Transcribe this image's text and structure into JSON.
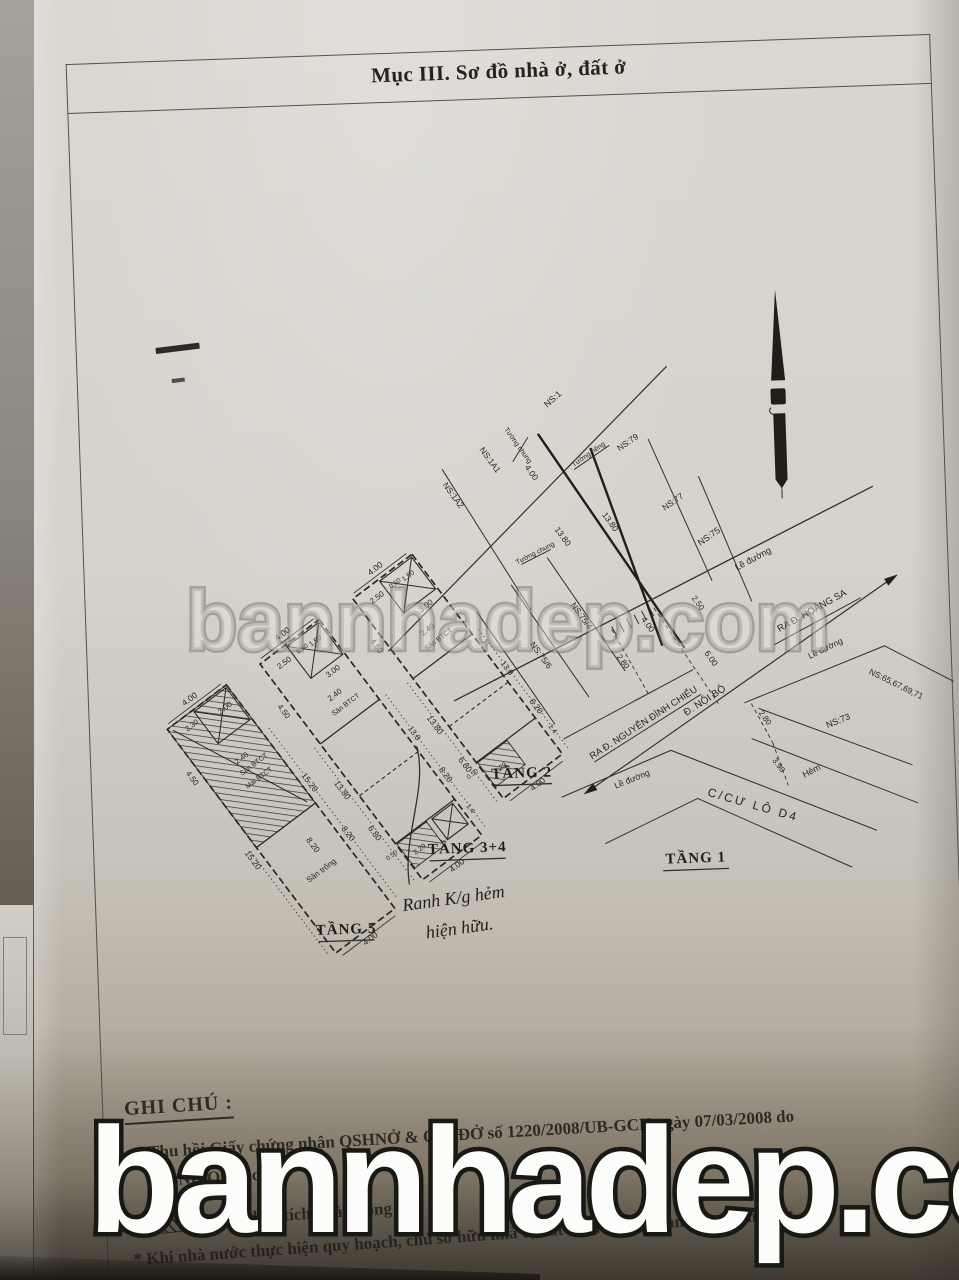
{
  "header": {
    "title": "Mục III. Sơ đồ nhà ở, đất ở"
  },
  "photo": {
    "watermark_text": "bannhadep.com"
  },
  "site_plan": {
    "floor_label": "TẦNG 1",
    "lots": {
      "ns1": "NS:1",
      "ns1a1": "NS:1A1",
      "ns1a2": "NS:1A2",
      "ns79": "NS:79",
      "ns77": "NS:77",
      "ns75": "NS:75",
      "ns75_4": "NS:75/4",
      "ns75_6": "NS:75/6",
      "ns73": "NS:73",
      "ns_group": "NS:65,67,69,71"
    },
    "walls": {
      "tuong_chung": "Tường chung",
      "tuong_rieng": "Tường riêng"
    },
    "streets": {
      "le_duong": "Lề đường",
      "ra_nguyen_dinh_chieu": "RA Đ. NGUYỄN ĐÌNH CHIỂU",
      "ra_hoang_sa": "RA Đ. HOÀNG SA",
      "noi_bo": "Đ. NỘI BỘ",
      "cu_lo_d4": "C/CƯ LÔ D4",
      "hem": "Hẻm"
    },
    "dims": {
      "front_w": "4.00",
      "d250": "2.50",
      "d280": "2.80",
      "d600": "6.00",
      "d280b": "2.80",
      "d390": "3.90",
      "len1": "13.80",
      "len2": "13.80",
      "w400": "4.00"
    }
  },
  "plans": {
    "tang2": {
      "label": "TẦNG 2",
      "yard": "Sân BTCT",
      "dims": {
        "w": "4.00",
        "a": "2.50",
        "b": "0.50",
        "c": "1.50",
        "d": "3.00",
        "e": "4.50",
        "f": "2.40",
        "len_l": "13.80",
        "len_r": "13.8",
        "g": "8.20",
        "h": "6.80",
        "i": "0.50",
        "j": "2.20",
        "k": "1.4",
        "front": "4.00"
      }
    },
    "tang34": {
      "label": "TẦNG 3+4",
      "yard": "Sân BTCT",
      "dims": {
        "w": "4.00",
        "a": "2.50",
        "b": "0.50",
        "c": "1.50",
        "d": "3.00",
        "e": "4.50",
        "f": "2.40",
        "len_l": "13.80",
        "len_r": "13.8",
        "g": "8.20",
        "h": "6.80",
        "i": "0.50",
        "j": "2.20",
        "k": "1.4",
        "front": "4.00"
      }
    },
    "tang5": {
      "label": "TẦNG 5",
      "yard": "Sân BTCT",
      "roof": "Mái BTCT",
      "open_yard": "Sân trống",
      "dims": {
        "w": "4.00",
        "a": "2.30",
        "d": "3.00",
        "e": "4.50",
        "f": "2.40",
        "len_l": "15.20",
        "len_r": "15.20",
        "g": "8.20",
        "h": "8.20",
        "front": "4.00"
      }
    }
  },
  "handwriting": {
    "line1": "Ranh K/g hẻm",
    "line2": "hiện hữu."
  },
  "notes": {
    "heading": "GHI CHÚ :",
    "line1": "* Thu hồi Giấy chứng nhận QSHNỞ & QSDĐỞ số 1220/2008/UB-GCN ngày 07/03/2008 do",
    "line2": "UBND Quận cấp.",
    "line3": "Phần diện tích nhà không",
    "line4": "* Khi nhà nước thực hiện quy hoạch, chủ sở hữu nhà ở, đất ở phải chấp hành theo qui định."
  }
}
